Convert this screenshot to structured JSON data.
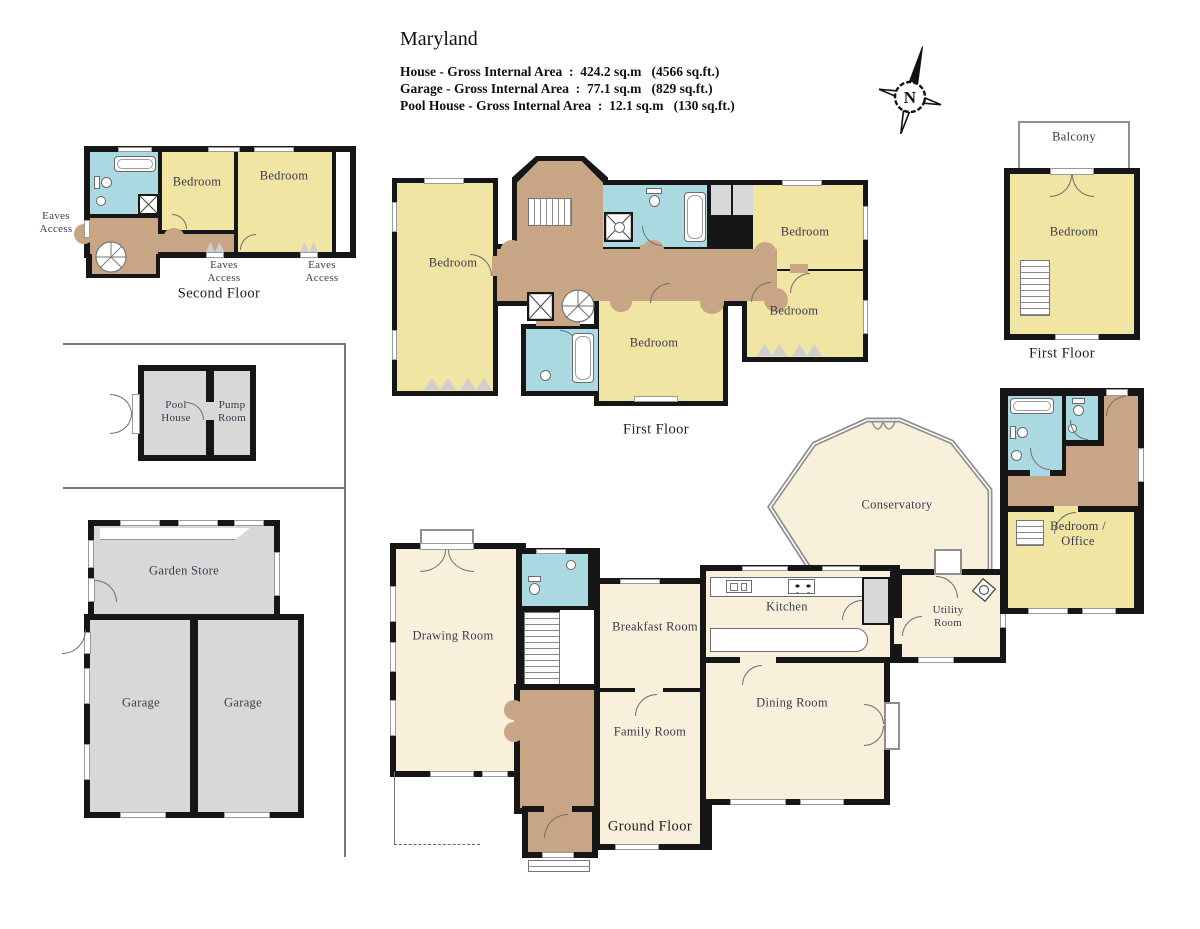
{
  "header": {
    "title": "Maryland",
    "areas": [
      "House - Gross Internal Area  :  424.2 sq.m   (4566 sq.ft.)",
      "Garage - Gross Internal Area  :  77.1 sq.m   (829 sq.ft.)",
      "Pool House - Gross Internal Area  :  12.1 sq.m   (130 sq.ft.)"
    ]
  },
  "compass": {
    "label": "N"
  },
  "second_floor": {
    "caption": "Second Floor",
    "bedroom_left": "Bedroom",
    "bedroom_right": "Bedroom",
    "eaves_access_left": "Eaves\nAccess",
    "eaves_access_center": "Eaves\nAccess",
    "eaves_access_right": "Eaves\nAccess"
  },
  "first_floor_main": {
    "caption": "First Floor",
    "bedroom_west": "Bedroom",
    "bedroom_northeast": "Bedroom",
    "bedroom_east": "Bedroom",
    "bedroom_south": "Bedroom"
  },
  "first_floor_annex": {
    "caption": "First Floor",
    "balcony": "Balcony",
    "bedroom": "Bedroom"
  },
  "pool_house_block": {
    "pool_house": "Pool\nHouse",
    "pump_room": "Pump\nRoom"
  },
  "garage_block": {
    "garden_store": "Garden Store",
    "garage_left": "Garage",
    "garage_right": "Garage"
  },
  "ground_floor": {
    "caption": "Ground Floor",
    "drawing_room": "Drawing Room",
    "breakfast_room": "Breakfast Room",
    "family_room": "Family Room",
    "kitchen": "Kitchen",
    "utility_room": "Utility\nRoom",
    "dining_room": "Dining Room",
    "conservatory": "Conservatory",
    "bedroom_office": "Bedroom /\nOffice"
  },
  "colors": {
    "bedroom_fill": "#f0e5a3",
    "reception_fill": "#f8f0db",
    "hall_fill": "#c8a685",
    "bathroom_fill": "#abd9e2",
    "garage_fill": "#d8d8d8",
    "wall": "#161616",
    "label_text": "#3a3a4e"
  }
}
